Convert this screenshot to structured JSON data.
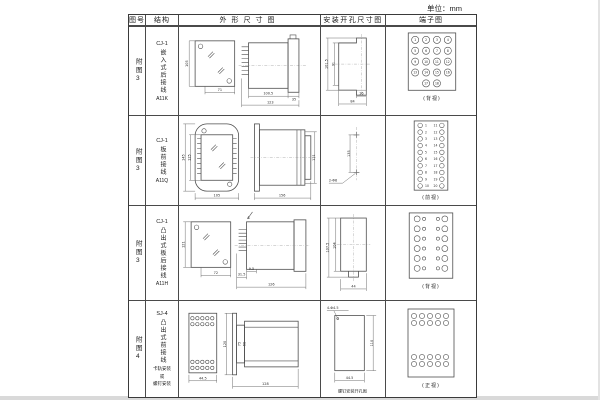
{
  "unit_label": "单位：mm",
  "table": {
    "headers": [
      "图号",
      "结构",
      "外形尺寸图",
      "安装开孔尺寸图",
      "端子图"
    ],
    "rows": [
      {
        "figure_no": "附图3",
        "model": "CJ-1",
        "structure": "嵌入式后接线",
        "code": "A11K",
        "outline": {
          "front_height": "105",
          "front_width": "71",
          "side_body": "100.5",
          "side_flange": "35",
          "side_total": "123"
        },
        "install": {
          "outer_height": "101.5",
          "inner_height": "91",
          "notch_width": "16",
          "outer_width": "84"
        },
        "terminal": {
          "view_label": "(背视)",
          "numbers": [
            "1",
            "2",
            "3",
            "4",
            "5",
            "6",
            "7",
            "8",
            "9",
            "10",
            "11",
            "12",
            "13",
            "14",
            "15",
            "16",
            "17",
            "18"
          ]
        }
      },
      {
        "figure_no": "附图3",
        "model": "CJ-1",
        "structure": "板前接线",
        "code": "A11Q",
        "outline": {
          "outer_height": "145",
          "inner_height": "125",
          "width": "105",
          "side_length": "156",
          "side_height": "121"
        },
        "install": {
          "spacing": "135",
          "holes": "2-Φ6"
        },
        "terminal": {
          "view_label": "(前视)",
          "left_numbers": [
            "1",
            "2",
            "3",
            "4",
            "5",
            "6",
            "7",
            "8",
            "9",
            "10"
          ],
          "right_numbers": [
            "11",
            "12",
            "13",
            "14",
            "15",
            "16",
            "17",
            "18",
            "19",
            "20"
          ]
        }
      },
      {
        "figure_no": "附图3",
        "model": "CJ-1",
        "structure": "凸出式板后接线",
        "code": "A11H",
        "outline": {
          "height": "121",
          "width": "72",
          "pins_depth": "31.5",
          "step": "9.5",
          "length": "126"
        },
        "install": {
          "outer_height": "107.5",
          "inner_height": "104",
          "width": "44"
        },
        "terminal": {
          "view_label": "(背视)"
        }
      },
      {
        "figure_no": "附图4",
        "model": "SJ-4",
        "structure": "凸出式前接线",
        "note_lines": [
          "卡轨安装",
          "或",
          "螺钉安装"
        ],
        "outline": {
          "front_width": "44.5",
          "side_height": "120",
          "inner_a": "75",
          "inner_b": "68",
          "length": "128"
        },
        "install": {
          "holes": "4-Φ4.5",
          "height": "110",
          "width": "44.5",
          "caption": "螺钉安装开孔图"
        },
        "terminal": {
          "view_label": "(正视)"
        }
      }
    ]
  }
}
